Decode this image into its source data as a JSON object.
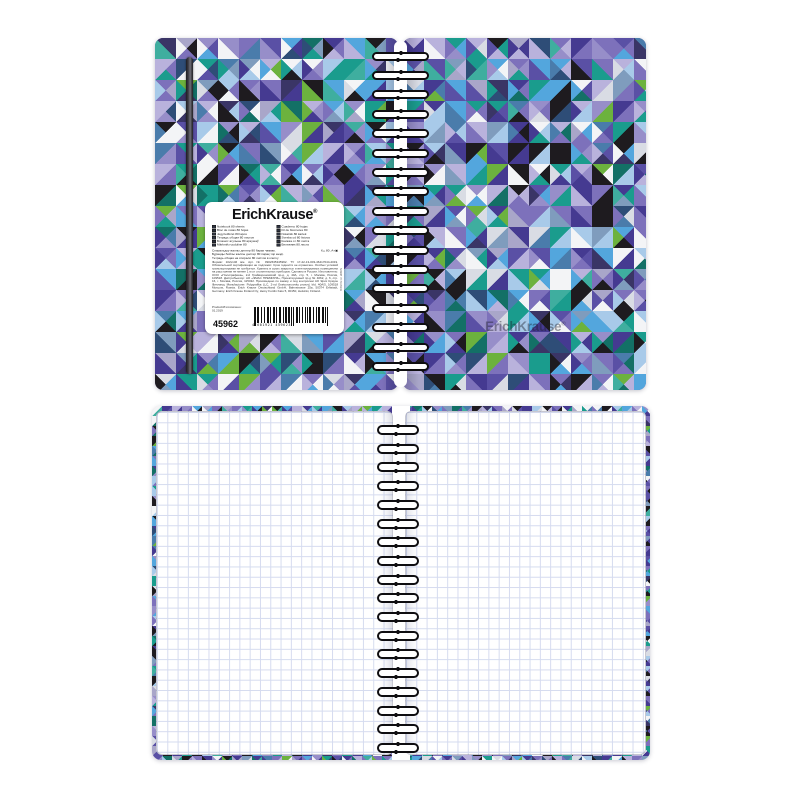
{
  "brand": {
    "name": "ErichKrause",
    "reg": "®"
  },
  "label": {
    "left_column": [
      "Notebook 80 sheets",
      "Bloc de notas 80 hojas",
      "Jegyzetfüzet 80 lapos",
      "Тетрадь общая 80 листов",
      "Блокнот агульны 80 аркушаў",
      "Märkmik ruuduline 80"
    ],
    "right_column": [
      "Cuaderno 80 hojas",
      "Fil de blocnotes 80",
      "Notatnik 80 kartek",
      "Sveska od 80 listova",
      "Книжка от 80 листа",
      "Бележник 80 листа"
    ],
    "wide_lines": [
      "Спиральдүү жалпы дептер 80 барак чакмак.",
      "Бұранды бойлы жалпы дәптер 80 парақ тор көзді.",
      "Тетрадь общая на спирали 80 листов в клетку"
    ],
    "spec_line": "К₂₅ 80 ,А+▣",
    "fine_print": "Формат 102х146 мм. Арт. № 0902635345962. ТУ 17-22-13-003-46417044-2019. Обязательной сертификации не подлежит. Срок годности не ограничен. Особых условий транспортировки не требуется. Хранить в сухих закрытых и вентилируемых помещениях на расстоянии не менее 1 м от отопительных приборов. Сделано в России. Изготовитель: ООО «Полиграфика», 2-й Грайвороновский пр-д, д. 40А, стр. 5, г. Москва, Россия, 109518. Дистрибьютор: АО «ЭМАС ПРЕМИУМ», Проектируемый пр-д № 4062, д. 6, стр. 16, г. Москва, Россия, 115432. Произведено по заказу и под контролем АО Эрих Краузе Финланд. Manufacturer: Polygrafika LLC, 2-nd Graivoronovsky proezd, bld. 40A/5, 109518 Moscow, Russia. Erich Krause Deutschland GmbH, Bahnstrasse 25a, 50374 Erftstadt, Germany. Erich Krause Finland Oy, Heiny Fordin Katu 5, 00150, Helsinki, Finland.",
    "made_label": "Product/Изготовлено:",
    "made_date": "01.2019",
    "sku": "45962",
    "barcode_digits": "4 601921 459623",
    "made_in_vertical": "Made in Russia"
  },
  "binding": {
    "closed_loop_count": 17,
    "open_loop_count": 18
  },
  "colors": {
    "page_white": "#ffffff",
    "grid_line": "#d5dbef",
    "wire": "#0e0d10",
    "elastic_band": "#3a393f",
    "cover_palette": [
      "#453a91",
      "#453a91",
      "#453a91",
      "#5a50a5",
      "#5a50a5",
      "#7d71bb",
      "#7d71bb",
      "#7d71bb",
      "#978ec9",
      "#978ec9",
      "#b9b2dc",
      "#b9b2dc",
      "#a9a6c9",
      "#1e1b1f",
      "#1e1b1f",
      "#1e1b1f",
      "#f3f4f6",
      "#f3f4f6",
      "#d9dce4",
      "#1a9c8d",
      "#1a9c8d",
      "#137066",
      "#3fae9f",
      "#6cb23e",
      "#53a6dd",
      "#53a6dd",
      "#a8cae9",
      "#a8cae9",
      "#4a7cab",
      "#2e4d77",
      "#7f9cbd",
      "#3a3566"
    ]
  }
}
